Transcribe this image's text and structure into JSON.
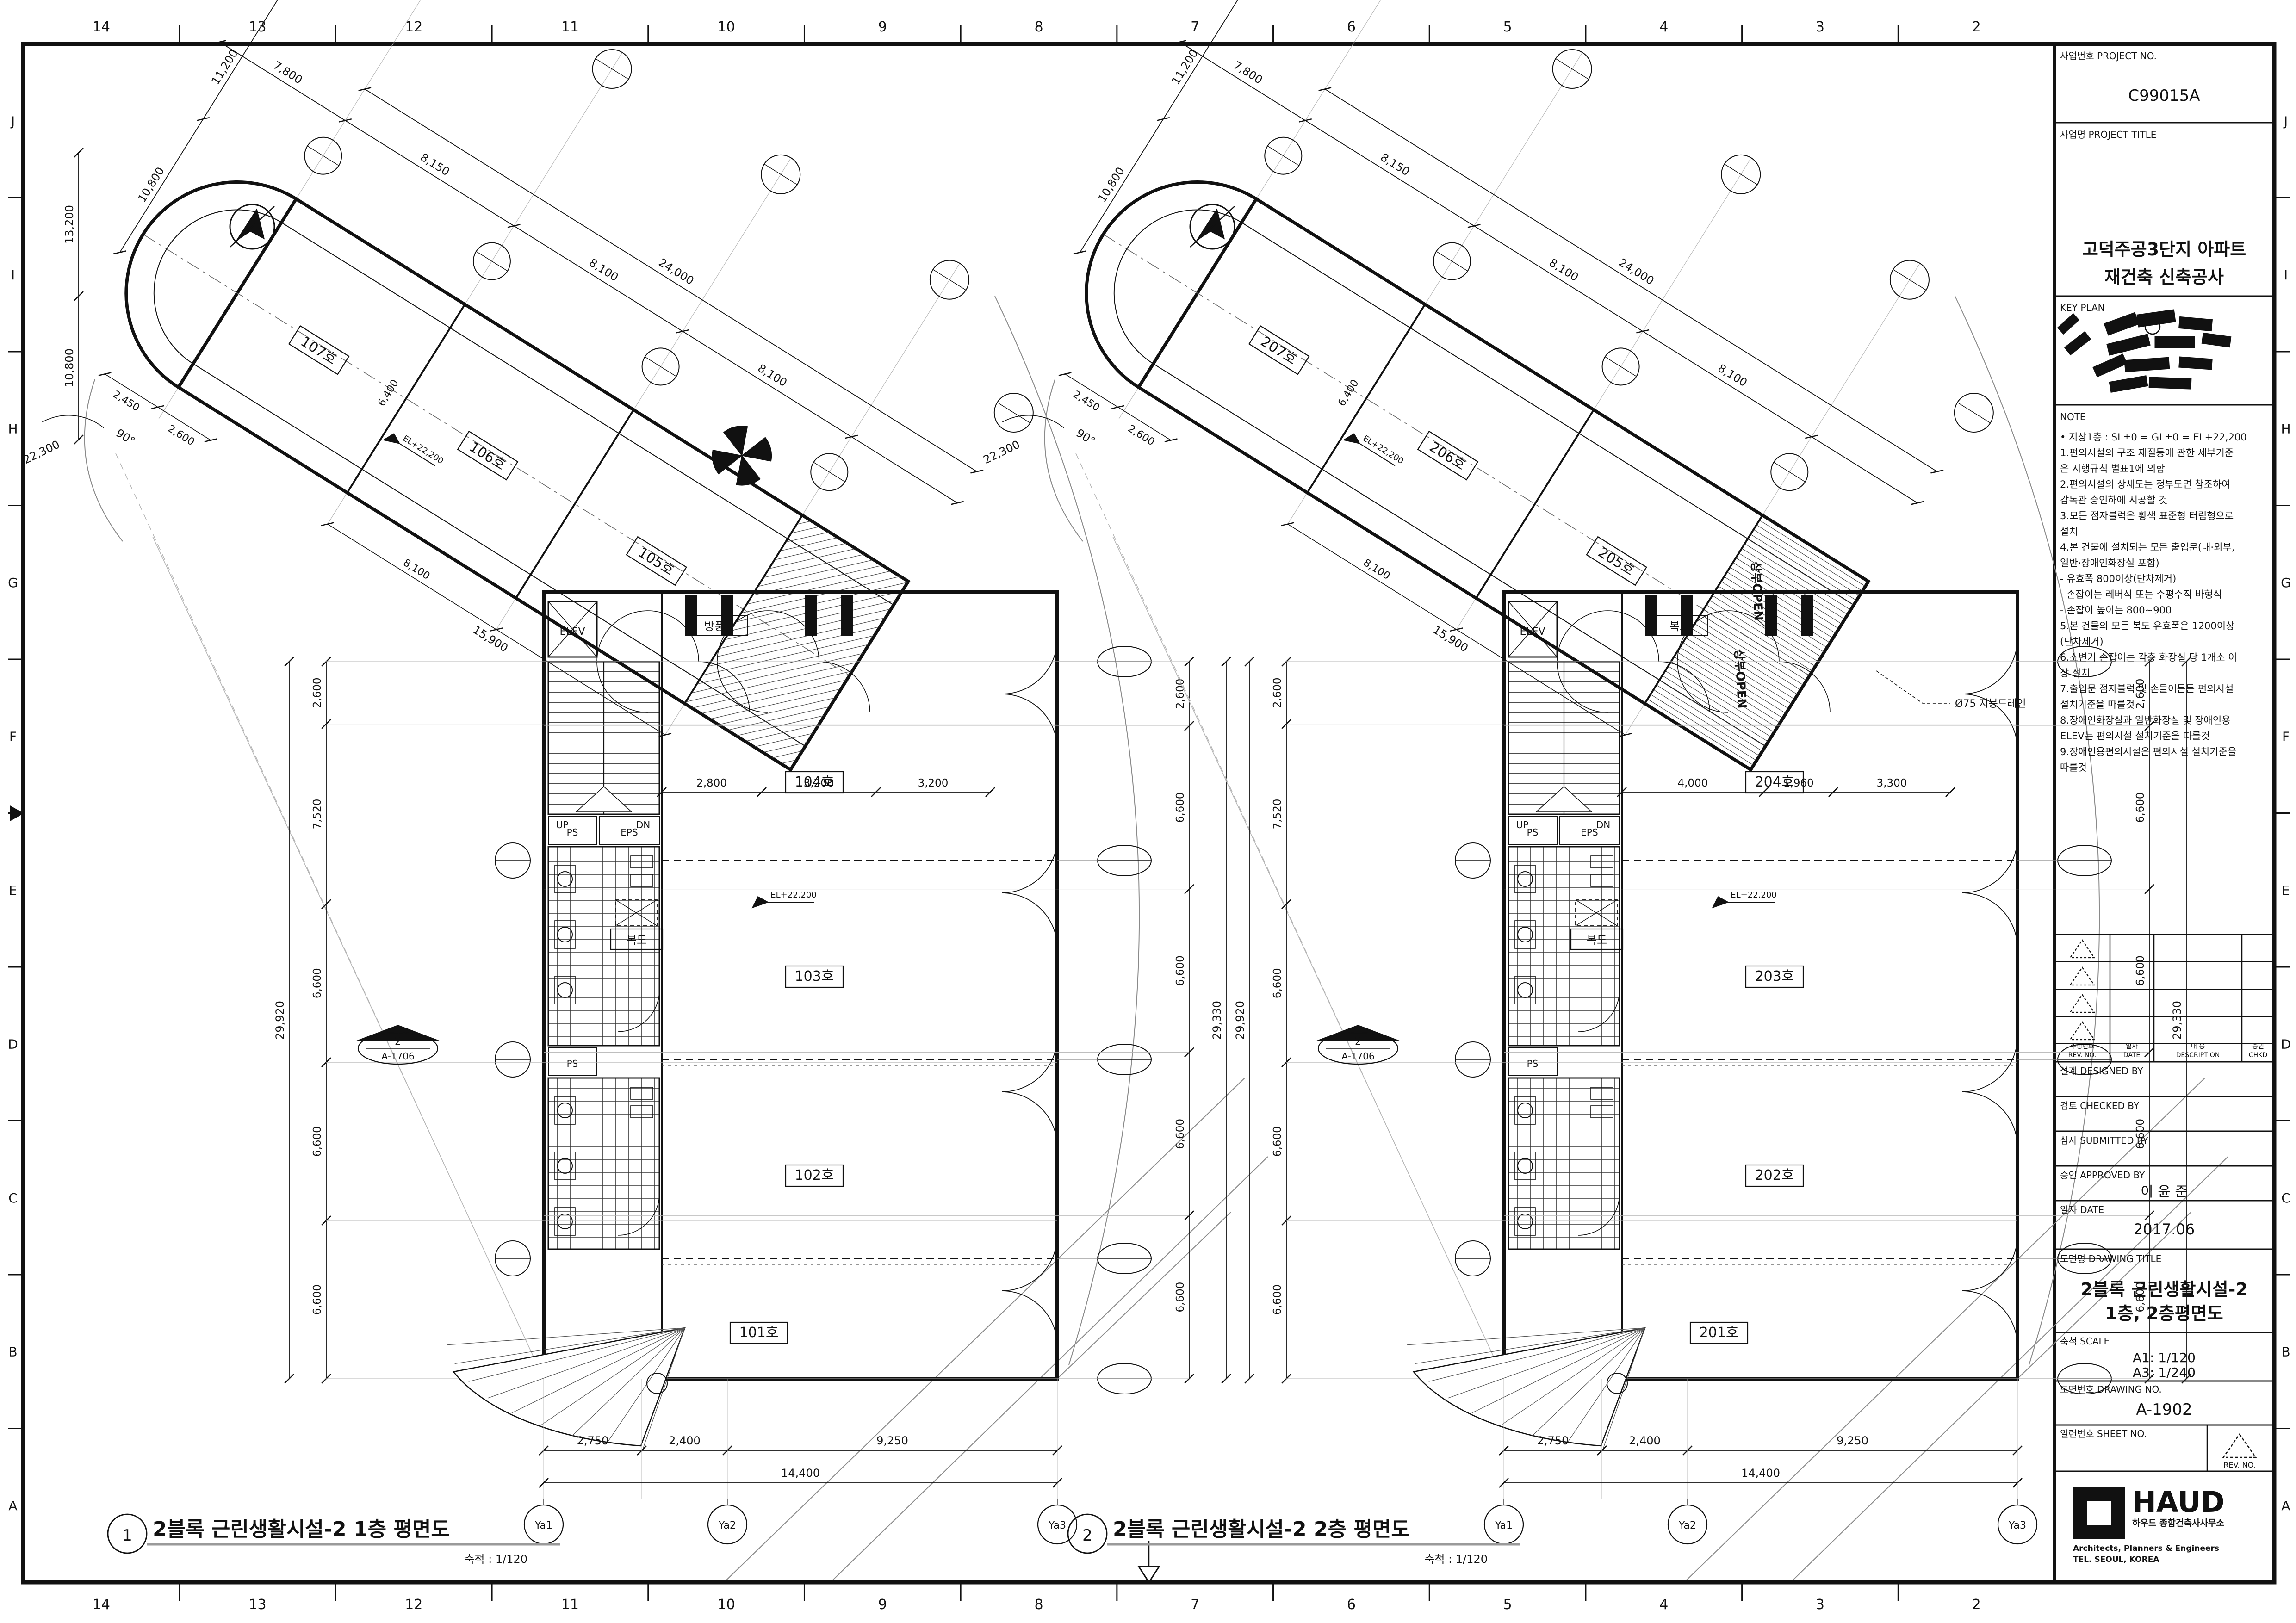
{
  "sheet": {
    "top_numbers": [
      "14",
      "13",
      "12",
      "11",
      "10",
      "9",
      "8",
      "7",
      "6",
      "5",
      "4",
      "3",
      "2"
    ],
    "bottom_numbers": [
      "14",
      "13",
      "12",
      "11",
      "10",
      "9",
      "8",
      "7",
      "6",
      "5",
      "4",
      "3",
      "2"
    ],
    "side_letters": [
      "J",
      "I",
      "H",
      "G",
      "F",
      "E",
      "D",
      "C",
      "B",
      "A"
    ]
  },
  "title_block": {
    "project_no_label": "사업번호 PROJECT NO.",
    "project_no": "C99015A",
    "project_title_label": "사업명 PROJECT TITLE",
    "project_title_line1": "고덕주공3단지 아파트",
    "project_title_line2": "재건축 신축공사",
    "key_plan_label": "KEY PLAN",
    "note_label": "NOTE",
    "notes": [
      "• 지상1층 : SL±0 = GL±0 = EL+22,200",
      "1.편의시설의 구조 재질등에 관한 세부기준",
      "  은 시행규칙 별표1에 의함",
      "2.편의시설의 상세도는 정부도면 참조하여",
      "  감독관 승인하에 시공할 것",
      "3.모든 점자블럭은 황색 표준형 터림형으로",
      "  설치",
      "4.본 건물에 설치되는 모든 출입문(내·외부,",
      "  일반·장애인화장실 포함)",
      "  - 유효폭 800이상(단차제거)",
      "  - 손잡이는 레버식 또는 수평수직 바형식",
      "  - 손잡이 높이는 800~900",
      "5.본 건물의 모든 복도 유효폭은 1200이상",
      "  (단차제거)",
      "6.소변기 손잡이는 각층 화장실 당 1개소 이",
      "  상 설치",
      "7.출입문 점자블럭 및 손들어든든 편의시설",
      "  설치기준을 따를것",
      "8.장애인화장실과 일반화장실 및 장애인용",
      "  ELEV는 편의시설 설치기준을 따를것",
      "9.장애인용편의시설은 편의시설 설치기준을",
      "  따를것"
    ],
    "rev_col1a": "수정번호",
    "rev_col1b": "REV. NO.",
    "rev_col2a": "일자",
    "rev_col2b": "DATE",
    "rev_col3a": "내  용",
    "rev_col3b": "DESCRIPTION",
    "rev_col4a": "승인",
    "rev_col4b": "CHKD",
    "designed_label": "설계 DESIGNED BY",
    "checked_label": "검토 CHECKED BY",
    "submitted_label": "심사 SUBMITTED BY",
    "approved_label": "승인 APPROVED BY",
    "approved_by": "이 윤 준",
    "date_label": "일자 DATE",
    "date_value": "2017.06",
    "drawing_title_label": "도면명 DRAWING TITLE",
    "drawing_title_line1": "2블록 근린생활시설-2",
    "drawing_title_line2": "1층, 2층평면도",
    "scale_label": "축척 SCALE",
    "scale_a1": "A1: 1/120",
    "scale_a3": "A3: 1/240",
    "drawing_no_label": "도면번호 DRAWING NO.",
    "drawing_no": "A-1902",
    "sheet_no_label": "일련번호 SHEET NO.",
    "rev_no_label": "REV. NO.",
    "logo_name": "HAUD",
    "logo_sub1": "하우드 종합건축사사무소",
    "logo_sub2": "Architects, Planners & Engineers",
    "logo_sub3": "TEL. SEOUL, KOREA"
  },
  "plans": [
    {
      "no": "1",
      "title": "2블록 근린생활시설-2 1층 평면도",
      "scale": "축척 : 1/120",
      "band_rooms": [
        "107호",
        "106호",
        "105호"
      ],
      "wing_rooms": [
        "104호",
        "103호",
        "102호",
        "101호"
      ],
      "labels": {
        "vestibule": "방풍실",
        "corridor": "복도",
        "elev": "ELEV",
        "ps": "PS",
        "eps": "EPS",
        "up": "UP",
        "dn": "DN",
        "level": "EL+22,200"
      },
      "sect_no": "2",
      "sect_ref": "A-1706",
      "dims": {
        "top_left": "7,800",
        "top_total": "24,000",
        "top_segs": [
          "8,150",
          "8,100",
          "8,100"
        ],
        "left_diag": [
          "11,200",
          "10,800"
        ],
        "far_left": [
          "13,200",
          "10,800"
        ],
        "cap_dims": [
          "2,450",
          "2,600"
        ],
        "angle": "90°",
        "radius": "22,300",
        "inner_diag": "15,900",
        "inner_seg": "8,100",
        "band_width": "6,400",
        "left_chain": [
          "2,600",
          "7,520",
          "6,600",
          "6,600",
          "6,600"
        ],
        "left_total": "29,920",
        "right_chain": [
          "2,600",
          "6,600",
          "6,600",
          "6,600",
          "6,600"
        ],
        "right_total": "29,330",
        "interior": [
          "2,800",
          "3,200",
          "3,200"
        ],
        "bottom": [
          "2,750",
          "2,400",
          "9,250"
        ],
        "bottom_total": "14,400",
        "grid_bottom": [
          "Ya1",
          "Ya2",
          "Ya3"
        ]
      },
      "extras": {}
    },
    {
      "no": "2",
      "title": "2블록 근린생활시설-2 2층 평면도",
      "scale": "축척 : 1/120",
      "band_rooms": [
        "207호",
        "206호",
        "205호"
      ],
      "wing_rooms": [
        "204호",
        "203호",
        "202호",
        "201호"
      ],
      "labels": {
        "vestibule": "복도",
        "corridor": "복도",
        "elev": "ELEV",
        "ps": "PS",
        "eps": "EPS",
        "up": "UP",
        "dn": "DN",
        "level": "EL+22,200"
      },
      "sect_no": "2",
      "sect_ref": "A-1706",
      "dims": {
        "top_left": "7,800",
        "top_total": "24,000",
        "top_segs": [
          "8,150",
          "8,100",
          "8,100"
        ],
        "left_diag": [
          "11,200",
          "10,800"
        ],
        "far_left": null,
        "cap_dims": [
          "2,450",
          "2,600"
        ],
        "angle": "90°",
        "radius": "22,300",
        "inner_diag": "15,900",
        "inner_seg": "8,100",
        "band_width": "6,400",
        "left_chain": [
          "2,600",
          "7,520",
          "6,600",
          "6,600",
          "6,600"
        ],
        "left_total": "29,920",
        "right_chain": [
          "2,600",
          "6,600",
          "6,600",
          "6,600",
          "6,600"
        ],
        "right_total": "29,330",
        "interior": [
          "4,000",
          "1,960",
          "3,300"
        ],
        "bottom": [
          "2,750",
          "2,400",
          "9,250"
        ],
        "bottom_total": "14,400",
        "grid_bottom": [
          "Ya1",
          "Ya2",
          "Ya3"
        ]
      },
      "extras": {
        "open_label": "상부OPEN",
        "drain_label": "Ø75 지붕드레인"
      }
    }
  ]
}
